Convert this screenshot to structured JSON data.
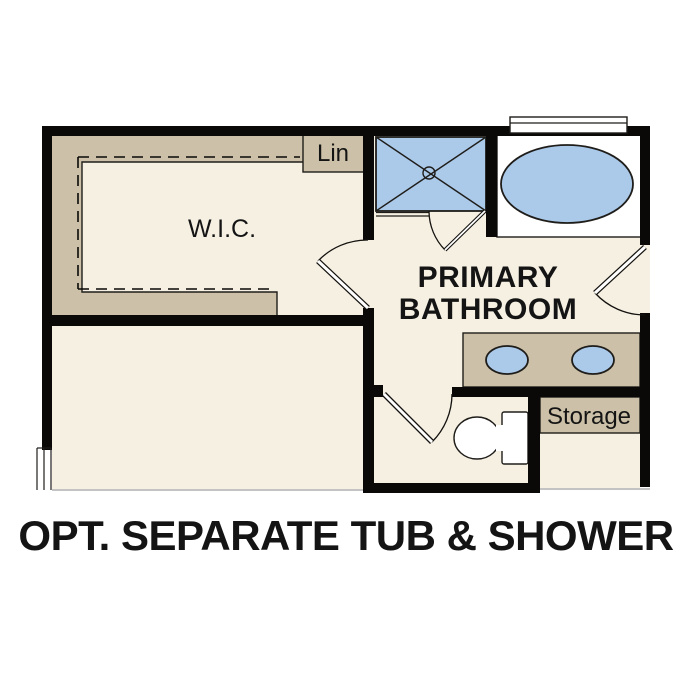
{
  "caption": "OPT. SEPARATE TUB & SHOWER",
  "rooms": {
    "wic": {
      "label": "W.I.C."
    },
    "linen_closet": {
      "label": "Lin"
    },
    "primary_bathroom": {
      "label_line1": "PRIMARY",
      "label_line2": "BATHROOM"
    },
    "storage": {
      "label": "Storage"
    }
  },
  "fixtures": [
    "walk-in-shower",
    "bathtub",
    "double-vanity-sinks",
    "toilet",
    "window",
    "closet-shelving"
  ],
  "colors": {
    "wall": "#0a0908",
    "floor": "#f6f0e2",
    "casework": "#ccc1a8",
    "fixture_blue": "#abc9e9",
    "outline": "#1f1d1a",
    "text": "#141414"
  }
}
